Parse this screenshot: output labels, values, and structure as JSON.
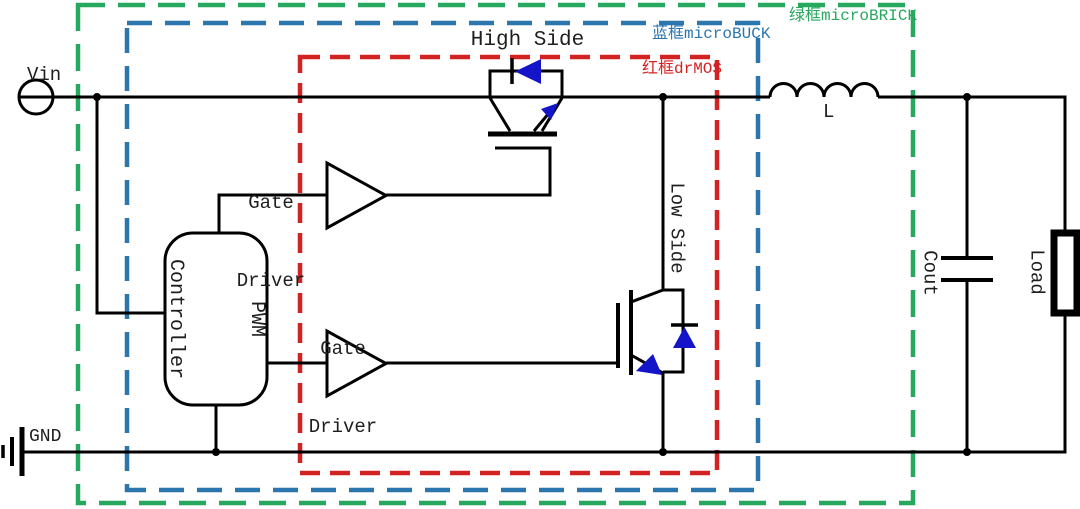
{
  "diagram_title": "Buck converter block diagram (microBRICK / microBUCK / drMOS scopes)",
  "frames": {
    "green": {
      "label": "绿框microBRICK",
      "color": "#27A85F"
    },
    "blue": {
      "label": "蓝框microBUCK",
      "color": "#2C76AE"
    },
    "red": {
      "label": "红框drMOS",
      "color": "#D32222"
    }
  },
  "components": {
    "vin": {
      "label": "Vin"
    },
    "gnd": {
      "label": "GND"
    },
    "pwm": {
      "line1": "PWM",
      "line2": "Controller"
    },
    "gate_driver_high": {
      "line1": "Gate",
      "line2": "Driver"
    },
    "gate_driver_low": {
      "line1": "Gate",
      "line2": "Driver"
    },
    "high_side": {
      "label": "High Side"
    },
    "low_side": {
      "label": "Low Side"
    },
    "inductor": {
      "label": "L"
    },
    "cout": {
      "label": "Cout"
    },
    "load": {
      "label": "Load"
    }
  },
  "colors": {
    "wire": "#000000",
    "diode_fill": "#1414C8",
    "background": "#ffffff",
    "text": "#1e1e1e"
  }
}
